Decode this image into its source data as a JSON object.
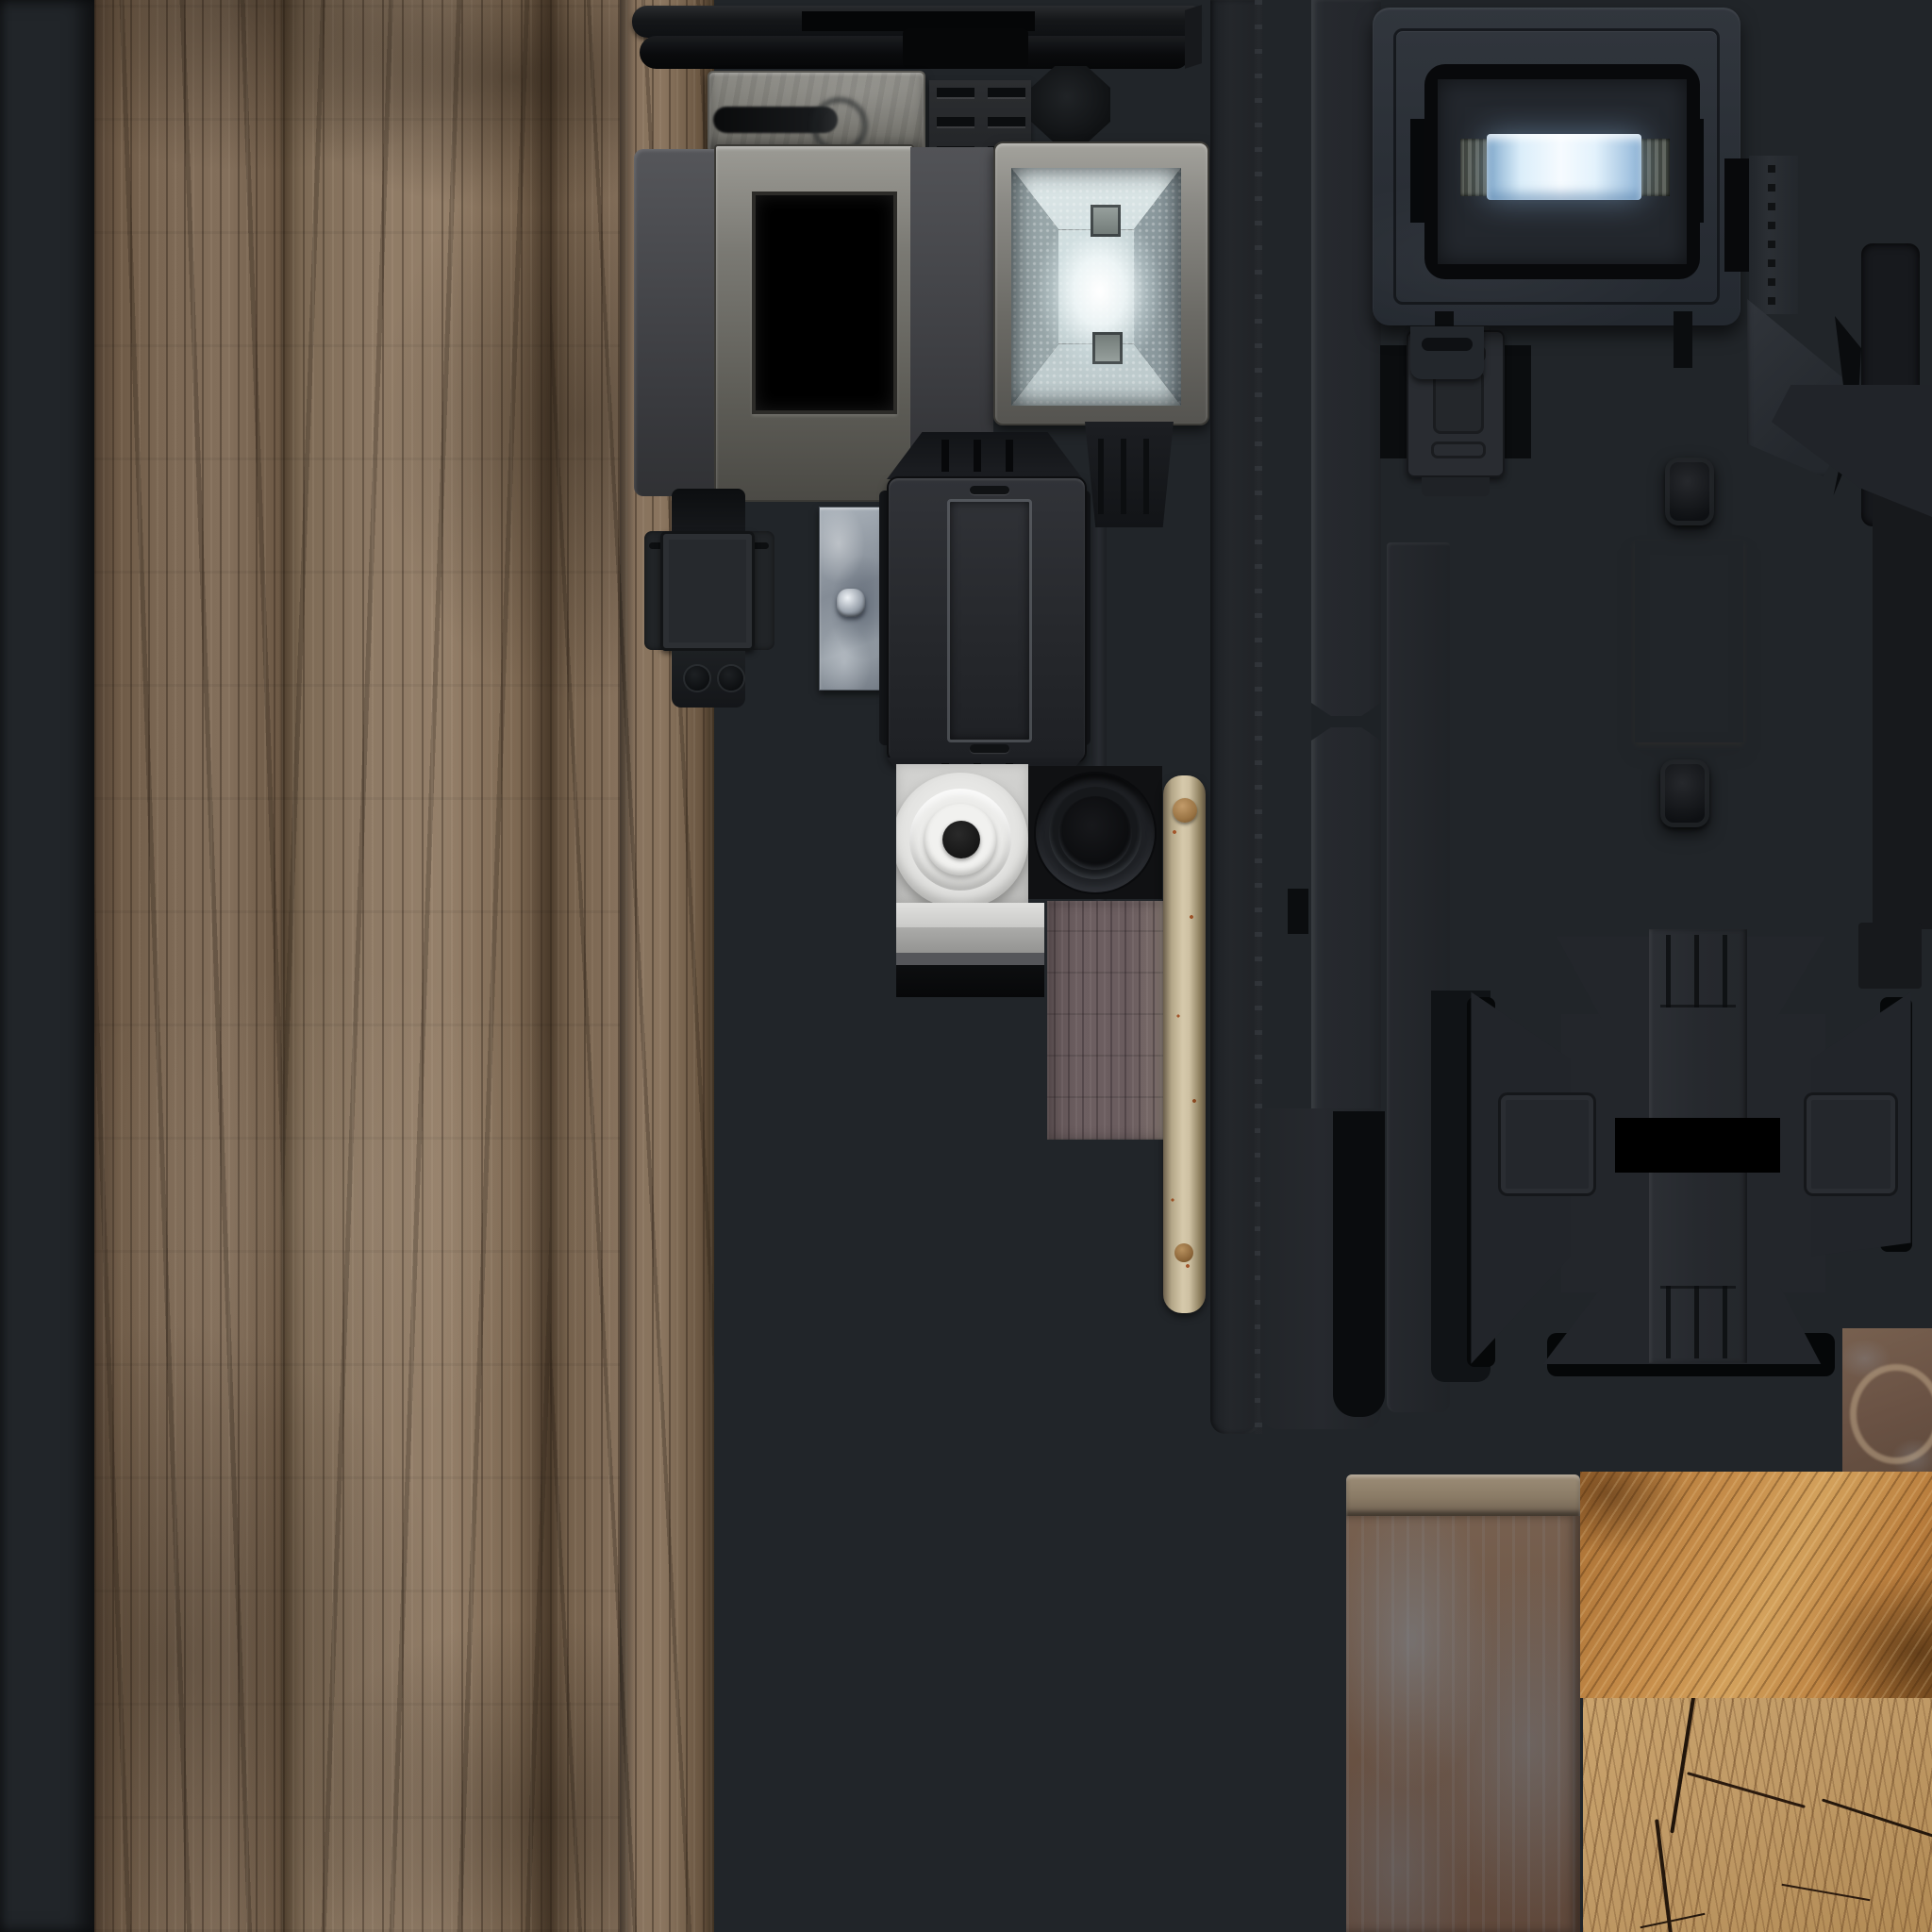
{
  "document": {
    "kind": "game-texture-atlas",
    "label": "Texture atlas sheet (2048x2048) with wood, fabric and machine-part textures",
    "has_visible_text": false
  },
  "palette": {
    "background_dark_slate": "#212529",
    "deep_black": "#0a0c0e",
    "metal_grey_light": "#9b9a94",
    "metal_grey_mid": "#6b6a65",
    "panel_slate": "#2b3037",
    "glow_blue": "#cfe7fa",
    "spotlight_white": "#f4fbfc",
    "perforated_plate": "#b2aea5",
    "wood_plank_brown": "#84705c",
    "wood_rough_orange": "#c08a4a",
    "wood_endgrain_tan": "#c09a66",
    "rust_brown": "#6e5748",
    "rust_blue_streak": "#7e8a96",
    "fabric_olive": "#3a3f33",
    "stick_cream": "#d6c9ab",
    "purple_wood": "#6a5c5e",
    "screw_gold": "#b59a5c"
  },
  "regions": {
    "fabric_strip": {
      "label": "woven olive fabric strip (diagonal ribs)"
    },
    "wood_planks": {
      "label": "weathered vertical wood planks with nails and knots"
    },
    "top_rails": {
      "label": "dark metal rail bars with screws"
    },
    "pill_panel": {
      "label": "grey metal plate with slotted pill hole"
    },
    "vent_dash_block": {
      "label": "dark vented block with dash slots"
    },
    "octagon_knob": {
      "label": "dark octagonal knob"
    },
    "vent_screen_panel": {
      "label": "vented panel with black screen window"
    },
    "spotlight": {
      "label": "spotlight reflector with bright bulb and mesh"
    },
    "clamp_bracket": {
      "label": "unfolded clamp bracket with screws and feet"
    },
    "galvanized_plate": {
      "label": "small galvanized plate with hex bolt"
    },
    "box_shell": {
      "label": "unfolded rectangular housing with recessed face"
    },
    "white_speaker": {
      "label": "white concentric speaker cone on light panel"
    },
    "black_speaker": {
      "label": "black speaker cone on dark panel"
    },
    "grey_bars": {
      "label": "light grey banded strip"
    },
    "purple_plank": {
      "label": "scratched purple-brown plank"
    },
    "birch_stick": {
      "label": "pale wooden stick with rust speckles and knob"
    },
    "vertical_rails": {
      "label": "long vertical rails and channels"
    },
    "blue_light_box": {
      "label": "panel with glowing blue light tube"
    },
    "corner_bracket": {
      "label": "angled corner bracket with screws"
    },
    "perforated_cross": {
      "label": "light perforated cross plate with dot bumps and black knobs"
    },
    "dark_cross": {
      "label": "dark cross plate with screw plates and ribbed column"
    },
    "ring_nuts": {
      "label": "small ring nuts on dark column"
    },
    "rust_panel": {
      "label": "rusted panel with blue-grey paint streaks and top lip"
    },
    "rough_wood": {
      "label": "rough-sawn orange wood block"
    },
    "end_grain": {
      "label": "cut log end grain with cracks"
    },
    "rust_ring_square": {
      "label": "small rusty square with pale ring mark"
    }
  }
}
